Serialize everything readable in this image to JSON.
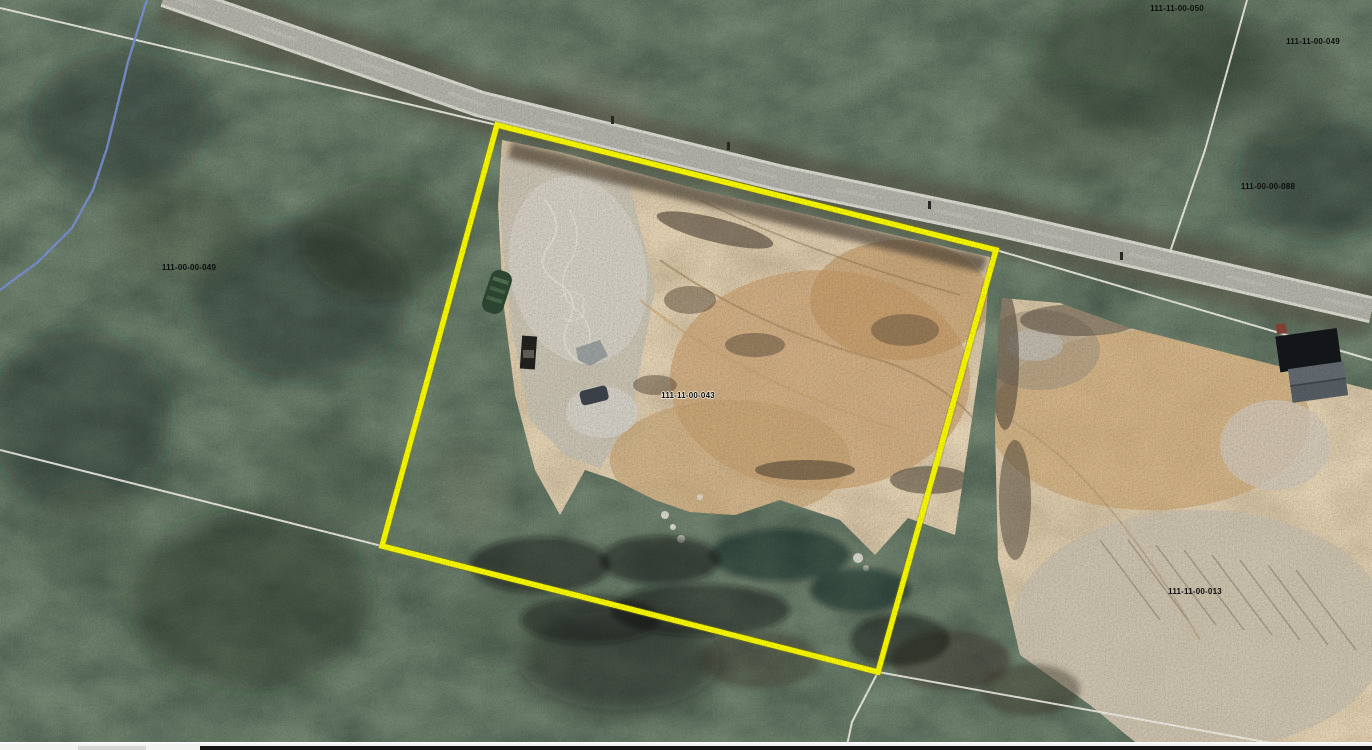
{
  "map": {
    "type": "aerial-parcel-map",
    "highlighted_parcel_id": "111-11-00-043",
    "parcels": [
      {
        "id": "111-11-00-050"
      },
      {
        "id": "111-11-00-049"
      },
      {
        "id": "111-00-00-088"
      },
      {
        "id": "111-00-00-049"
      },
      {
        "id": "111-11-00-043"
      },
      {
        "id": "111-11-00-013"
      }
    ],
    "colors": {
      "highlight_outline": "#ffff00",
      "parcel_line": "#f4f2ea",
      "stream_line": "#7b93d6",
      "road_surface": "#b6b6ae",
      "forest_base": "#2a342c",
      "cleared_dirt": "#c3a173"
    }
  }
}
